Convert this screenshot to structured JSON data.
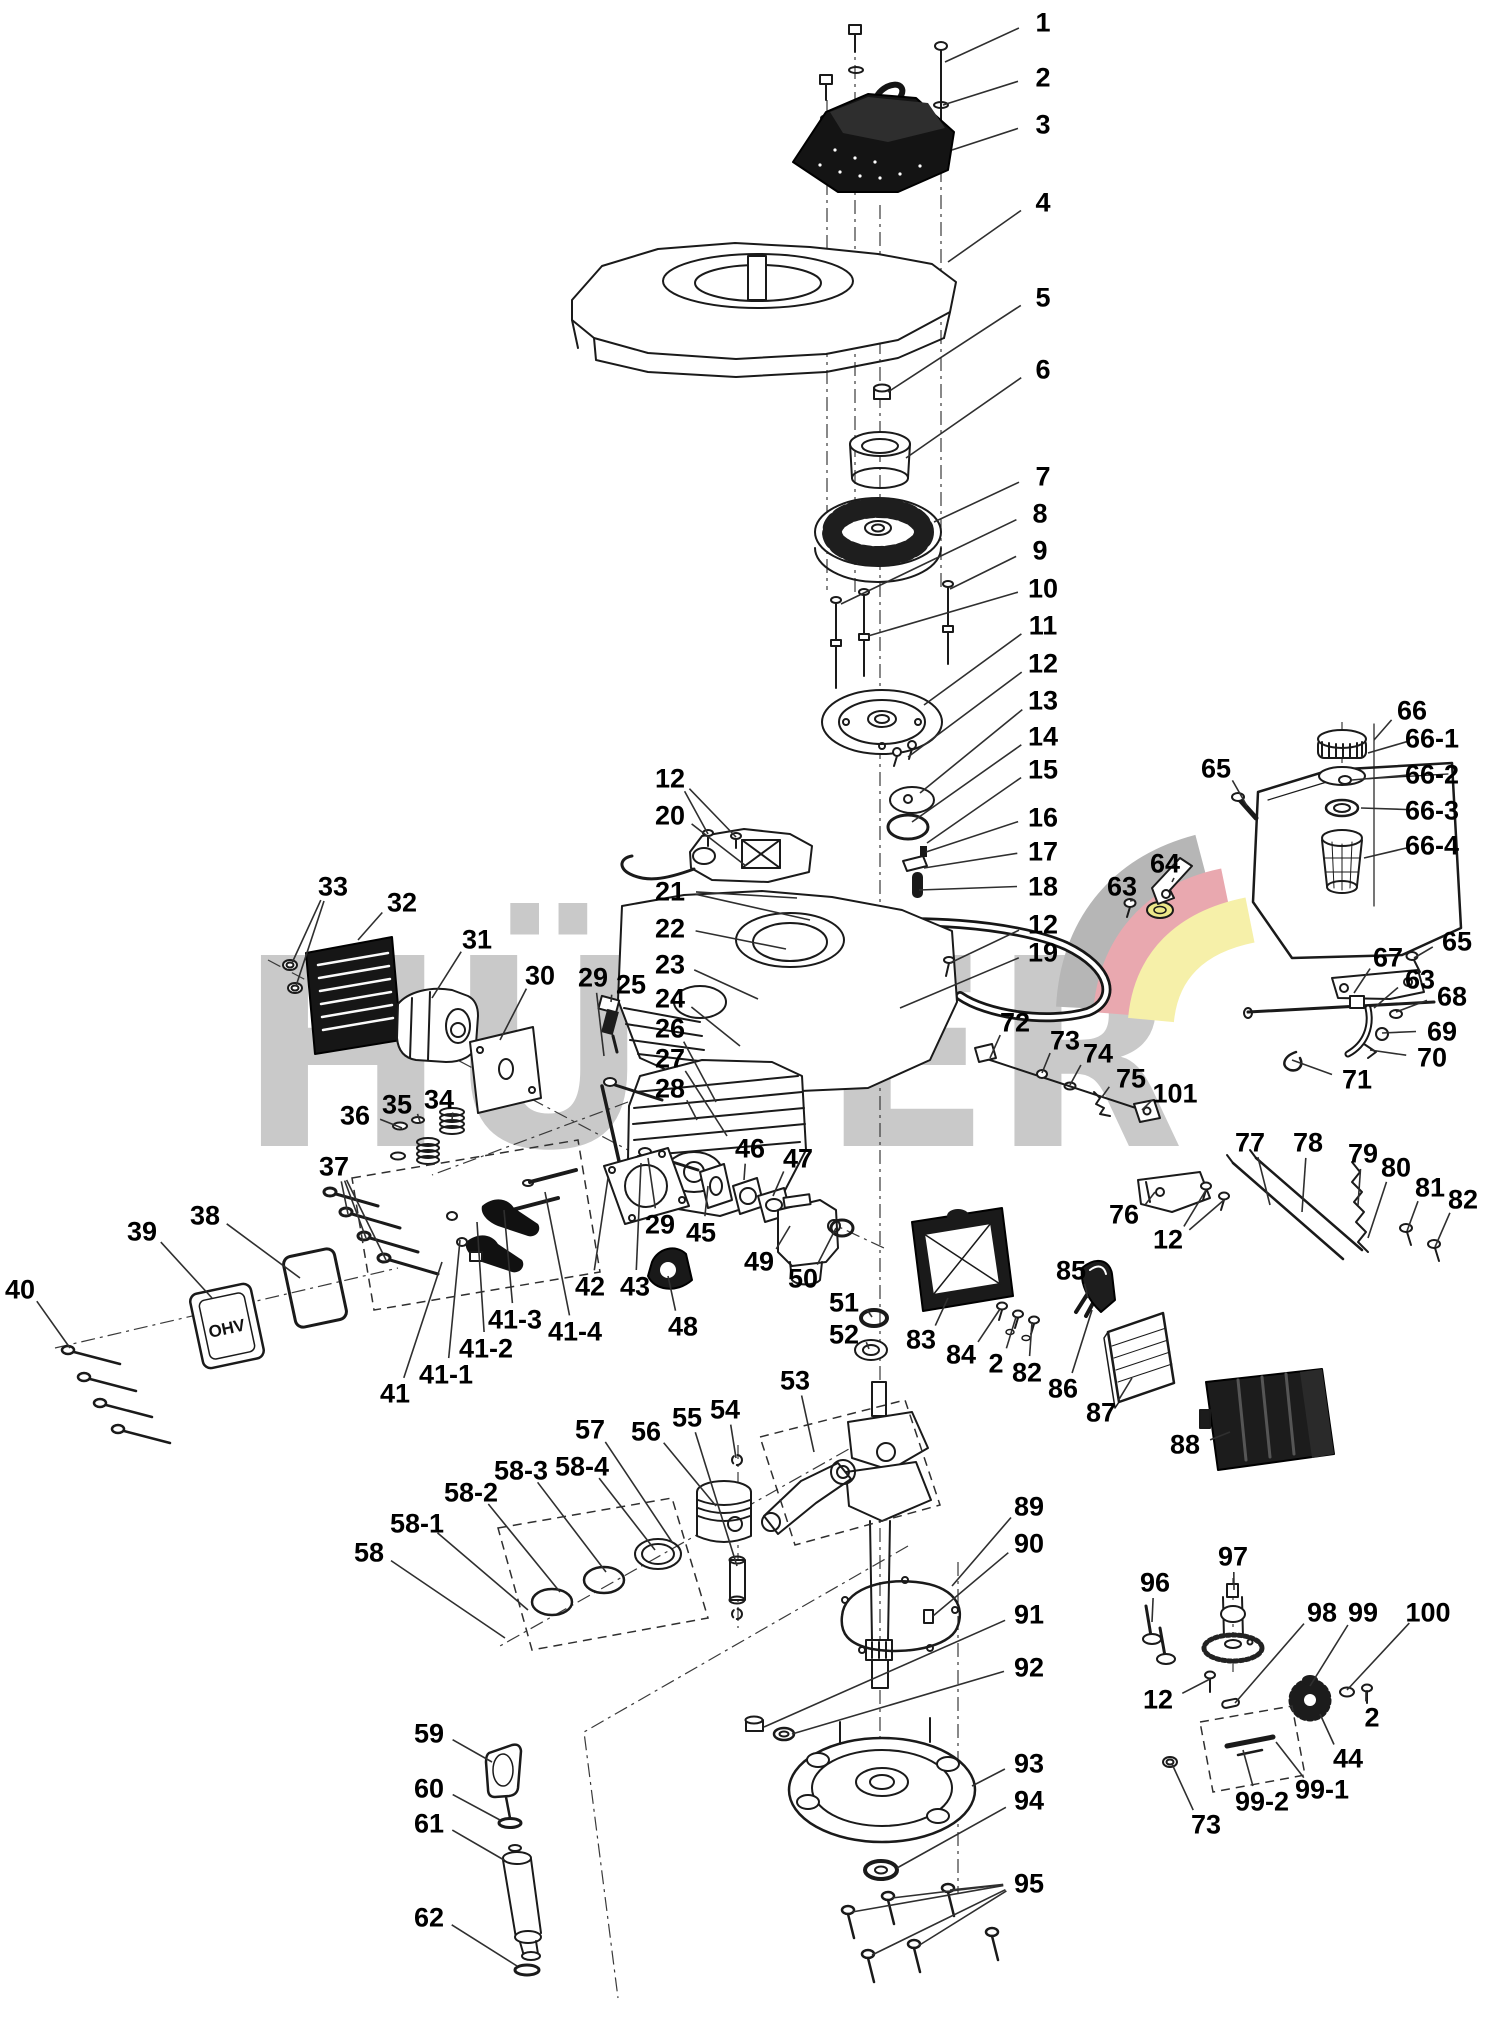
{
  "watermark": {
    "text": "HÜTER",
    "color": "#c9c9c9",
    "logo": {
      "gray": "#b6b6b6",
      "red": "#e9a8af",
      "yellow": "#f6f0a9",
      "washer_yellow": "#ece789"
    }
  },
  "valve_cover_text": "OHV",
  "labels": [
    {
      "t": "1",
      "x": 1043,
      "y": 22,
      "to": [
        [
          945,
          62
        ]
      ]
    },
    {
      "t": "2",
      "x": 1043,
      "y": 77,
      "to": [
        [
          943,
          105
        ]
      ]
    },
    {
      "t": "3",
      "x": 1043,
      "y": 124,
      "to": [
        [
          952,
          150
        ]
      ]
    },
    {
      "t": "4",
      "x": 1043,
      "y": 202,
      "to": [
        [
          948,
          262
        ]
      ]
    },
    {
      "t": "5",
      "x": 1043,
      "y": 297,
      "to": [
        [
          888,
          392
        ]
      ]
    },
    {
      "t": "6",
      "x": 1043,
      "y": 369,
      "to": [
        [
          906,
          458
        ]
      ]
    },
    {
      "t": "7",
      "x": 1043,
      "y": 476,
      "to": [
        [
          934,
          522
        ]
      ]
    },
    {
      "t": "8",
      "x": 1040,
      "y": 513,
      "to": [
        [
          841,
          604
        ]
      ]
    },
    {
      "t": "9",
      "x": 1040,
      "y": 550,
      "to": [
        [
          950,
          589
        ]
      ]
    },
    {
      "t": "10",
      "x": 1043,
      "y": 588,
      "to": [
        [
          868,
          636
        ]
      ]
    },
    {
      "t": "11",
      "x": 1043,
      "y": 625,
      "to": [
        [
          924,
          705
        ]
      ]
    },
    {
      "t": "12",
      "x": 1043,
      "y": 663,
      "to": [
        [
          908,
          757
        ]
      ]
    },
    {
      "t": "13",
      "x": 1043,
      "y": 700,
      "to": [
        [
          920,
          793
        ]
      ]
    },
    {
      "t": "14",
      "x": 1043,
      "y": 736,
      "to": [
        [
          912,
          822
        ]
      ]
    },
    {
      "t": "15",
      "x": 1043,
      "y": 769,
      "to": [
        [
          927,
          843
        ]
      ]
    },
    {
      "t": "16",
      "x": 1043,
      "y": 817,
      "to": [
        [
          926,
          852
        ]
      ]
    },
    {
      "t": "17",
      "x": 1043,
      "y": 851,
      "to": [
        [
          924,
          868
        ]
      ]
    },
    {
      "t": "18",
      "x": 1043,
      "y": 886,
      "to": [
        [
          919,
          890
        ]
      ]
    },
    {
      "t": "12",
      "x": 1043,
      "y": 924,
      "to": [
        [
          950,
          963
        ]
      ]
    },
    {
      "t": "19",
      "x": 1043,
      "y": 952,
      "to": [
        [
          900,
          1008
        ]
      ]
    },
    {
      "t": "66",
      "x": 1412,
      "y": 710,
      "to": [
        [
          1374,
          740
        ]
      ]
    },
    {
      "t": "66-1",
      "x": 1432,
      "y": 738,
      "to": [
        [
          1368,
          753
        ]
      ]
    },
    {
      "t": "66-2",
      "x": 1432,
      "y": 774,
      "to": [
        [
          1352,
          780
        ]
      ]
    },
    {
      "t": "66-3",
      "x": 1432,
      "y": 810,
      "to": [
        [
          1361,
          808
        ]
      ]
    },
    {
      "t": "66-4",
      "x": 1432,
      "y": 845,
      "to": [
        [
          1364,
          858
        ]
      ]
    },
    {
      "t": "65",
      "x": 1216,
      "y": 768,
      "to": [
        [
          1247,
          806
        ]
      ]
    },
    {
      "t": "65",
      "x": 1457,
      "y": 941,
      "to": [
        [
          1414,
          958
        ]
      ]
    },
    {
      "t": "64",
      "x": 1165,
      "y": 863,
      "to": [
        [
          1172,
          882
        ]
      ]
    },
    {
      "t": "63",
      "x": 1122,
      "y": 886,
      "to": [
        [
          1130,
          901
        ]
      ]
    },
    {
      "t": "67",
      "x": 1388,
      "y": 957,
      "to": [
        [
          1354,
          993
        ]
      ]
    },
    {
      "t": "63",
      "x": 1420,
      "y": 979,
      "to": [
        [
          1374,
          1008
        ]
      ]
    },
    {
      "t": "68",
      "x": 1452,
      "y": 996,
      "to": [
        [
          1396,
          1012
        ]
      ]
    },
    {
      "t": "69",
      "x": 1442,
      "y": 1031,
      "to": [
        [
          1382,
          1033
        ]
      ]
    },
    {
      "t": "70",
      "x": 1432,
      "y": 1057,
      "to": [
        [
          1370,
          1050
        ]
      ]
    },
    {
      "t": "71",
      "x": 1357,
      "y": 1079,
      "to": [
        [
          1292,
          1060
        ]
      ]
    },
    {
      "t": "72",
      "x": 1015,
      "y": 1022,
      "to": [
        [
          990,
          1058
        ]
      ]
    },
    {
      "t": "73",
      "x": 1065,
      "y": 1040,
      "to": [
        [
          1042,
          1073
        ]
      ]
    },
    {
      "t": "74",
      "x": 1098,
      "y": 1053,
      "to": [
        [
          1070,
          1085
        ]
      ]
    },
    {
      "t": "75",
      "x": 1131,
      "y": 1078,
      "to": [
        [
          1102,
          1097
        ]
      ]
    },
    {
      "t": "101",
      "x": 1175,
      "y": 1093,
      "to": [
        [
          1142,
          1110
        ]
      ]
    },
    {
      "t": "76",
      "x": 1124,
      "y": 1214,
      "to": [
        [
          1155,
          1192
        ]
      ]
    },
    {
      "t": "12",
      "x": 1168,
      "y": 1239,
      "to": [
        [
          1206,
          1190
        ],
        [
          1224,
          1200
        ]
      ]
    },
    {
      "t": "77",
      "x": 1250,
      "y": 1142,
      "to": [
        [
          1270,
          1205
        ]
      ]
    },
    {
      "t": "78",
      "x": 1308,
      "y": 1142,
      "to": [
        [
          1302,
          1212
        ]
      ]
    },
    {
      "t": "79",
      "x": 1363,
      "y": 1153,
      "to": [
        [
          1358,
          1205
        ]
      ]
    },
    {
      "t": "80",
      "x": 1396,
      "y": 1167,
      "to": [
        [
          1368,
          1238
        ]
      ]
    },
    {
      "t": "81",
      "x": 1430,
      "y": 1187,
      "to": [
        [
          1407,
          1231
        ]
      ]
    },
    {
      "t": "82",
      "x": 1463,
      "y": 1199,
      "to": [
        [
          1435,
          1247
        ]
      ]
    },
    {
      "t": "85",
      "x": 1071,
      "y": 1270,
      "to": [
        [
          1088,
          1298
        ]
      ]
    },
    {
      "t": "83",
      "x": 921,
      "y": 1339,
      "to": [
        [
          948,
          1298
        ]
      ]
    },
    {
      "t": "84",
      "x": 961,
      "y": 1354,
      "to": [
        [
          1000,
          1309
        ]
      ]
    },
    {
      "t": "2",
      "x": 996,
      "y": 1363,
      "to": [
        [
          1016,
          1317
        ]
      ]
    },
    {
      "t": "82",
      "x": 1027,
      "y": 1372,
      "to": [
        [
          1032,
          1322
        ]
      ]
    },
    {
      "t": "86",
      "x": 1063,
      "y": 1388,
      "to": [
        [
          1092,
          1310
        ]
      ]
    },
    {
      "t": "87",
      "x": 1101,
      "y": 1412,
      "to": [
        [
          1132,
          1378
        ]
      ]
    },
    {
      "t": "88",
      "x": 1185,
      "y": 1444,
      "to": [
        [
          1230,
          1432
        ]
      ]
    },
    {
      "t": "89",
      "x": 1029,
      "y": 1506,
      "to": [
        [
          952,
          1586
        ]
      ]
    },
    {
      "t": "90",
      "x": 1029,
      "y": 1543,
      "to": [
        [
          933,
          1616
        ]
      ]
    },
    {
      "t": "91",
      "x": 1029,
      "y": 1614,
      "to": [
        [
          764,
          1727
        ]
      ]
    },
    {
      "t": "92",
      "x": 1029,
      "y": 1667,
      "to": [
        [
          792,
          1734
        ]
      ]
    },
    {
      "t": "93",
      "x": 1029,
      "y": 1763,
      "to": [
        [
          972,
          1786
        ]
      ]
    },
    {
      "t": "94",
      "x": 1029,
      "y": 1800,
      "to": [
        [
          897,
          1868
        ]
      ]
    },
    {
      "t": "95",
      "x": 1029,
      "y": 1883,
      "to": [
        [
          852,
          1912
        ],
        [
          892,
          1898
        ],
        [
          950,
          1890
        ],
        [
          872,
          1955
        ],
        [
          918,
          1946
        ]
      ]
    },
    {
      "t": "96",
      "x": 1155,
      "y": 1582,
      "to": [
        [
          1152,
          1622
        ]
      ]
    },
    {
      "t": "97",
      "x": 1233,
      "y": 1556,
      "to": [
        [
          1234,
          1590
        ]
      ]
    },
    {
      "t": "98",
      "x": 1322,
      "y": 1612,
      "to": [
        [
          1235,
          1703
        ]
      ]
    },
    {
      "t": "99",
      "x": 1363,
      "y": 1612,
      "to": [
        [
          1310,
          1686
        ]
      ]
    },
    {
      "t": "100",
      "x": 1428,
      "y": 1612,
      "to": [
        [
          1347,
          1690
        ]
      ]
    },
    {
      "t": "12",
      "x": 1158,
      "y": 1699,
      "to": [
        [
          1210,
          1679
        ]
      ]
    },
    {
      "t": "2",
      "x": 1372,
      "y": 1717,
      "to": [
        [
          1366,
          1692
        ]
      ]
    },
    {
      "t": "44",
      "x": 1348,
      "y": 1758,
      "to": [
        [
          1320,
          1714
        ]
      ]
    },
    {
      "t": "99-1",
      "x": 1322,
      "y": 1789,
      "to": [
        [
          1276,
          1742
        ]
      ]
    },
    {
      "t": "99-2",
      "x": 1262,
      "y": 1801,
      "to": [
        [
          1243,
          1750
        ]
      ]
    },
    {
      "t": "73",
      "x": 1206,
      "y": 1824,
      "to": [
        [
          1172,
          1764
        ]
      ]
    },
    {
      "t": "33",
      "x": 333,
      "y": 886,
      "to": [
        [
          292,
          963
        ],
        [
          296,
          986
        ]
      ]
    },
    {
      "t": "32",
      "x": 402,
      "y": 902,
      "to": [
        [
          358,
          940
        ]
      ]
    },
    {
      "t": "31",
      "x": 477,
      "y": 939,
      "to": [
        [
          432,
          998
        ]
      ]
    },
    {
      "t": "30",
      "x": 540,
      "y": 975,
      "to": [
        [
          500,
          1040
        ]
      ]
    },
    {
      "t": "29",
      "x": 593,
      "y": 977,
      "to": [
        [
          604,
          1056
        ]
      ]
    },
    {
      "t": "25",
      "x": 631,
      "y": 984,
      "to": [
        [
          611,
          1002
        ]
      ]
    },
    {
      "t": "36",
      "x": 355,
      "y": 1115,
      "to": [
        [
          402,
          1128
        ]
      ]
    },
    {
      "t": "35",
      "x": 397,
      "y": 1104,
      "to": [
        [
          420,
          1122
        ]
      ]
    },
    {
      "t": "34",
      "x": 439,
      "y": 1099,
      "to": [
        [
          452,
          1120
        ]
      ]
    },
    {
      "t": "37",
      "x": 334,
      "y": 1166,
      "to": [
        [
          348,
          1214
        ],
        [
          366,
          1238
        ],
        [
          386,
          1260
        ]
      ]
    },
    {
      "t": "38",
      "x": 205,
      "y": 1215,
      "to": [
        [
          300,
          1278
        ]
      ]
    },
    {
      "t": "39",
      "x": 142,
      "y": 1231,
      "to": [
        [
          212,
          1298
        ]
      ]
    },
    {
      "t": "40",
      "x": 20,
      "y": 1289,
      "to": [
        [
          70,
          1348
        ]
      ]
    },
    {
      "t": "41",
      "x": 395,
      "y": 1393,
      "to": [
        [
          442,
          1262
        ]
      ]
    },
    {
      "t": "41-1",
      "x": 446,
      "y": 1374,
      "to": [
        [
          460,
          1240
        ]
      ]
    },
    {
      "t": "41-2",
      "x": 486,
      "y": 1348,
      "to": [
        [
          477,
          1222
        ]
      ]
    },
    {
      "t": "41-3",
      "x": 515,
      "y": 1319,
      "to": [
        [
          504,
          1210
        ]
      ]
    },
    {
      "t": "41-4",
      "x": 575,
      "y": 1331,
      "to": [
        [
          545,
          1192
        ]
      ]
    },
    {
      "t": "42",
      "x": 590,
      "y": 1286,
      "to": [
        [
          608,
          1178
        ]
      ]
    },
    {
      "t": "43",
      "x": 635,
      "y": 1286,
      "to": [
        [
          641,
          1163
        ]
      ]
    },
    {
      "t": "29",
      "x": 660,
      "y": 1224,
      "to": [
        [
          648,
          1158
        ]
      ]
    },
    {
      "t": "45",
      "x": 701,
      "y": 1232,
      "to": [
        [
          708,
          1186
        ]
      ]
    },
    {
      "t": "46",
      "x": 750,
      "y": 1148,
      "to": [
        [
          744,
          1180
        ]
      ]
    },
    {
      "t": "47",
      "x": 798,
      "y": 1158,
      "to": [
        [
          773,
          1196
        ]
      ]
    },
    {
      "t": "49",
      "x": 759,
      "y": 1261,
      "to": [
        [
          790,
          1226
        ]
      ]
    },
    {
      "t": "50",
      "x": 803,
      "y": 1278,
      "to": [
        [
          836,
          1228
        ]
      ]
    },
    {
      "t": "48",
      "x": 683,
      "y": 1326,
      "to": [
        [
          668,
          1276
        ]
      ]
    },
    {
      "t": "51",
      "x": 844,
      "y": 1302,
      "to": [
        [
          872,
          1317
        ]
      ]
    },
    {
      "t": "52",
      "x": 844,
      "y": 1334,
      "to": [
        [
          869,
          1349
        ]
      ]
    },
    {
      "t": "53",
      "x": 795,
      "y": 1380,
      "to": [
        [
          814,
          1452
        ]
      ]
    },
    {
      "t": "54",
      "x": 725,
      "y": 1409,
      "to": [
        [
          736,
          1458
        ]
      ]
    },
    {
      "t": "55",
      "x": 687,
      "y": 1417,
      "to": [
        [
          737,
          1566
        ]
      ]
    },
    {
      "t": "56",
      "x": 646,
      "y": 1431,
      "to": [
        [
          716,
          1506
        ]
      ]
    },
    {
      "t": "57",
      "x": 590,
      "y": 1429,
      "to": [
        [
          672,
          1542
        ]
      ]
    },
    {
      "t": "58-4",
      "x": 582,
      "y": 1466,
      "to": [
        [
          655,
          1550
        ]
      ]
    },
    {
      "t": "58-3",
      "x": 521,
      "y": 1470,
      "to": [
        [
          606,
          1572
        ]
      ]
    },
    {
      "t": "58-2",
      "x": 471,
      "y": 1492,
      "to": [
        [
          560,
          1592
        ]
      ]
    },
    {
      "t": "58-1",
      "x": 417,
      "y": 1523,
      "to": [
        [
          528,
          1610
        ]
      ]
    },
    {
      "t": "58",
      "x": 369,
      "y": 1552,
      "to": [
        [
          505,
          1638
        ]
      ]
    },
    {
      "t": "59",
      "x": 429,
      "y": 1733,
      "to": [
        [
          492,
          1762
        ]
      ]
    },
    {
      "t": "60",
      "x": 429,
      "y": 1788,
      "to": [
        [
          500,
          1820
        ]
      ]
    },
    {
      "t": "61",
      "x": 429,
      "y": 1823,
      "to": [
        [
          504,
          1860
        ]
      ]
    },
    {
      "t": "62",
      "x": 429,
      "y": 1917,
      "to": [
        [
          517,
          1966
        ]
      ]
    },
    {
      "t": "12",
      "x": 670,
      "y": 778,
      "to": [
        [
          708,
          834
        ],
        [
          736,
          837
        ]
      ]
    },
    {
      "t": "20",
      "x": 670,
      "y": 815,
      "to": [
        [
          746,
          866
        ]
      ]
    },
    {
      "t": "21",
      "x": 670,
      "y": 891,
      "to": [
        [
          797,
          898
        ],
        [
          810,
          920
        ]
      ]
    },
    {
      "t": "22",
      "x": 670,
      "y": 928,
      "to": [
        [
          786,
          949
        ]
      ]
    },
    {
      "t": "23",
      "x": 670,
      "y": 964,
      "to": [
        [
          758,
          999
        ]
      ]
    },
    {
      "t": "24",
      "x": 670,
      "y": 998,
      "to": [
        [
          740,
          1046
        ]
      ]
    },
    {
      "t": "26",
      "x": 670,
      "y": 1028,
      "to": [
        [
          716,
          1102
        ]
      ]
    },
    {
      "t": "27",
      "x": 670,
      "y": 1058,
      "to": [
        [
          727,
          1136
        ]
      ]
    },
    {
      "t": "28",
      "x": 670,
      "y": 1088,
      "to": [
        [
          697,
          1120
        ]
      ]
    }
  ]
}
